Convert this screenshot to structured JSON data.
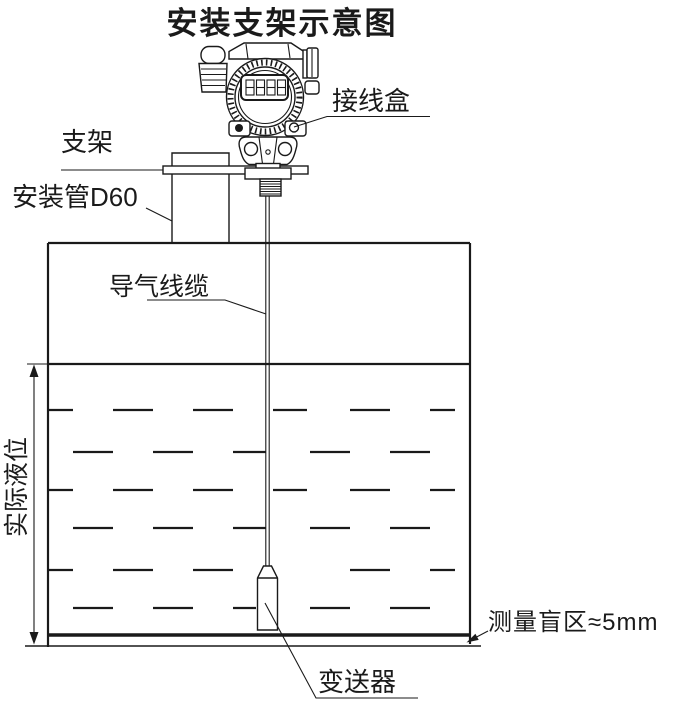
{
  "diagram": {
    "title": "安装支架示意图",
    "labels": {
      "junction_box": "接线盒",
      "bracket": "支架",
      "mounting_pipe": "安装管D60",
      "air_cable": "导气线缆",
      "actual_level": "实际液位",
      "transmitter": "变送器",
      "blind_zone": "测量盲区≈5mm"
    },
    "colors": {
      "line": "#1a1a1a",
      "background": "#ffffff"
    }
  }
}
